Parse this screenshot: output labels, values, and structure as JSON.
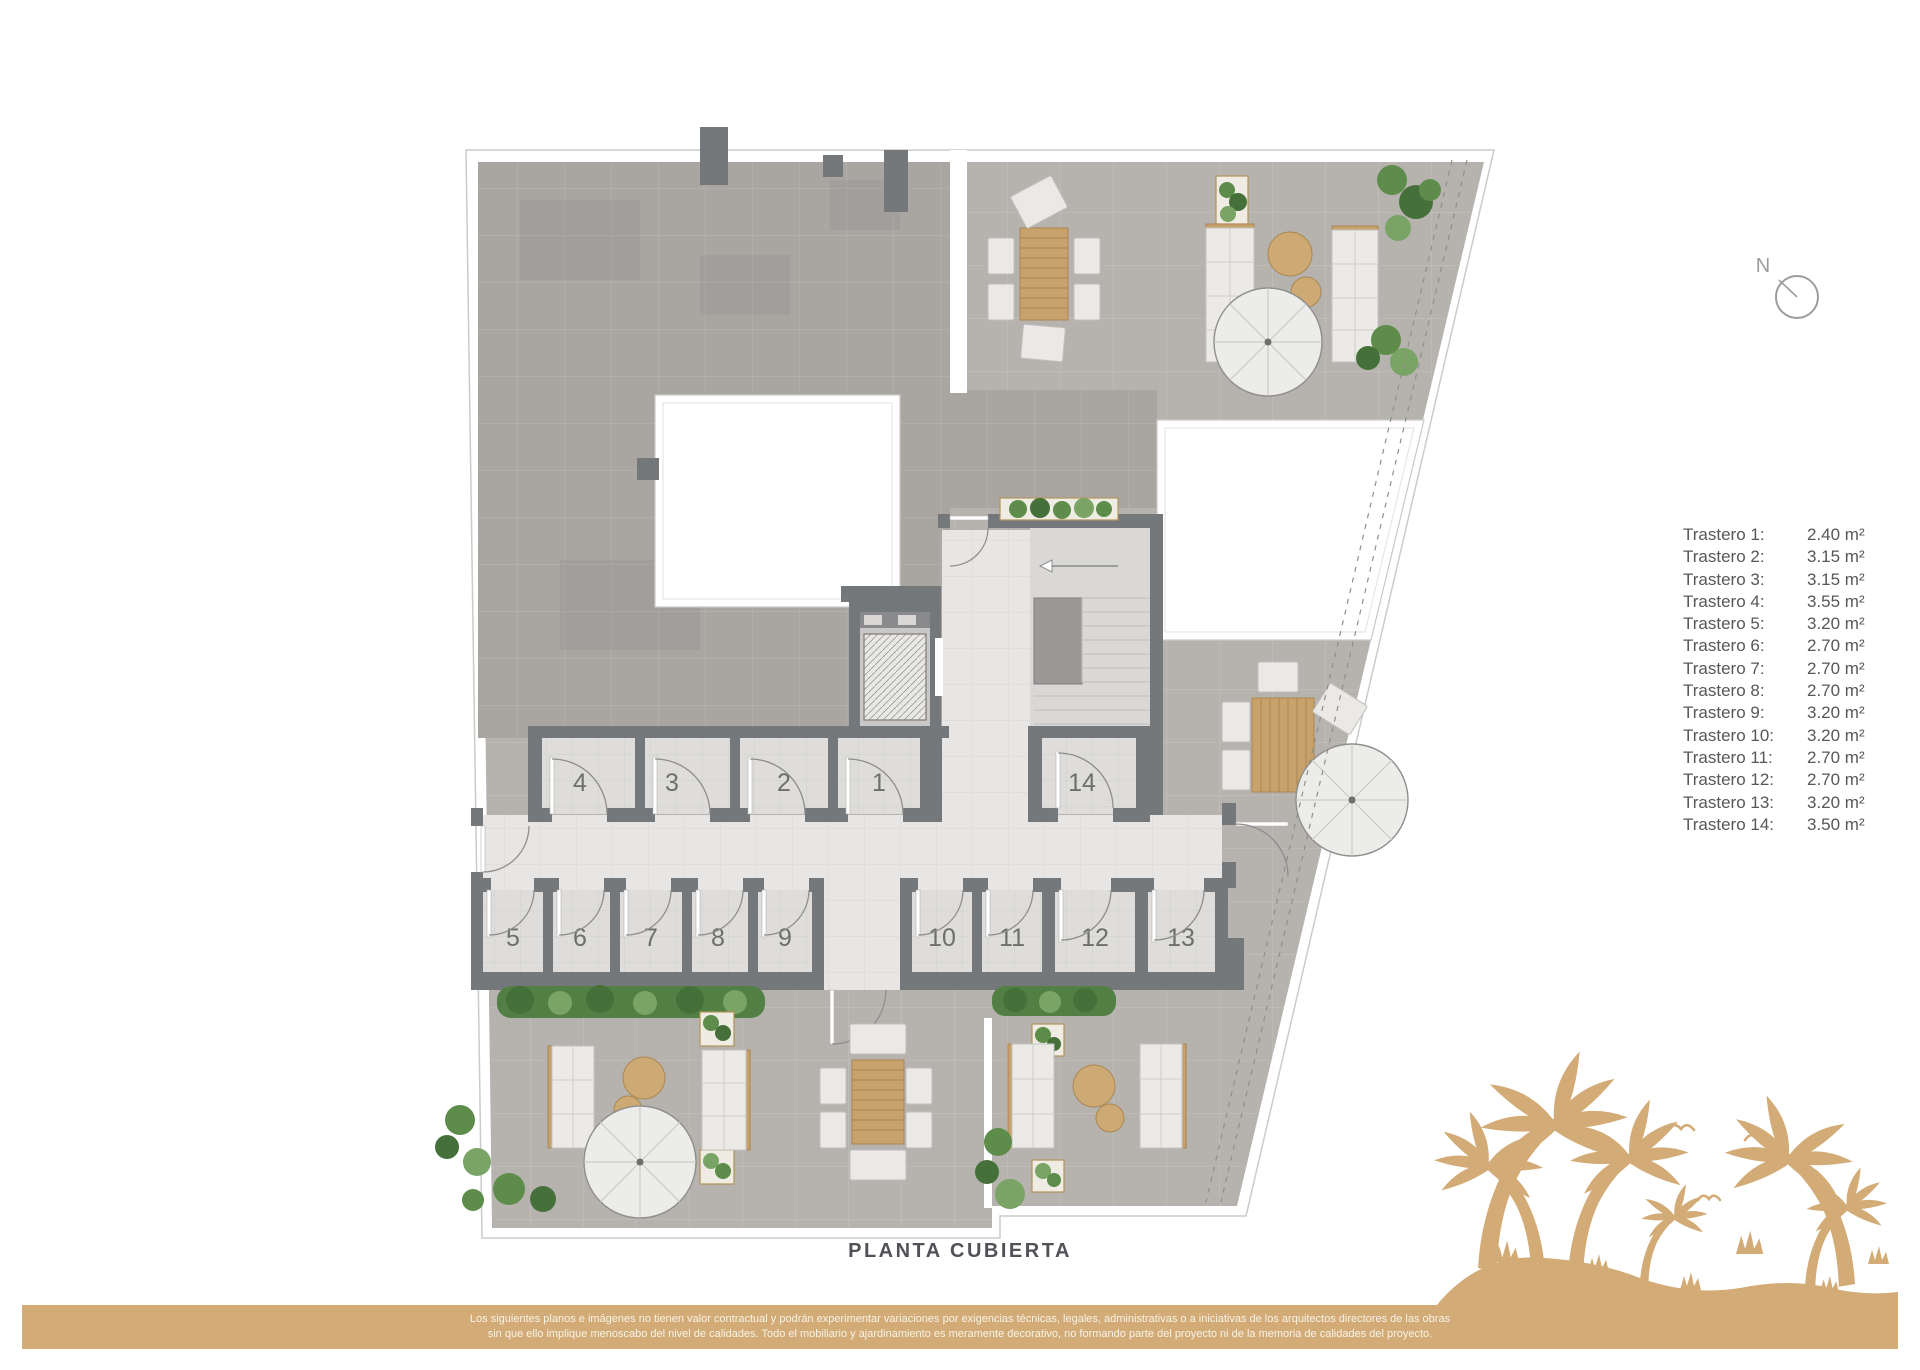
{
  "plan": {
    "title": "PLANTA CUBIERTA",
    "compass": {
      "label": "N"
    },
    "room_numbers": [
      "1",
      "2",
      "3",
      "4",
      "5",
      "6",
      "7",
      "8",
      "9",
      "10",
      "11",
      "12",
      "13",
      "14"
    ]
  },
  "legend": {
    "items": [
      {
        "label": "Trastero 1:",
        "value": "2.40 m²"
      },
      {
        "label": "Trastero 2:",
        "value": "3.15 m²"
      },
      {
        "label": "Trastero 3:",
        "value": "3.15 m²"
      },
      {
        "label": "Trastero 4:",
        "value": "3.55 m²"
      },
      {
        "label": "Trastero 5:",
        "value": "3.20 m²"
      },
      {
        "label": "Trastero 6:",
        "value": "2.70 m²"
      },
      {
        "label": "Trastero 7:",
        "value": "2.70 m²"
      },
      {
        "label": "Trastero 8:",
        "value": "2.70 m²"
      },
      {
        "label": "Trastero 9:",
        "value": "3.20 m²"
      },
      {
        "label": "Trastero 10:",
        "value": "3.20 m²"
      },
      {
        "label": "Trastero 11:",
        "value": "2.70 m²"
      },
      {
        "label": "Trastero 12:",
        "value": "2.70 m²"
      },
      {
        "label": "Trastero 13:",
        "value": "3.20 m²"
      },
      {
        "label": "Trastero 14:",
        "value": "3.50 m²"
      }
    ]
  },
  "footer": {
    "disclaimer_line1": "Los siguientes planos e imágenes no tienen valor contractual y podrán experimentar variaciones por exigencias técnicas, legales, administrativas o a iniciativas de los arquitectos directores de las obras",
    "disclaimer_line2": "sin que ello implique menoscabo del nivel de calidades. Todo el mobiliario y ajardinamiento es meramente decorativo, no formando parte del proyecto ni de la memoria de calidades del proyecto."
  },
  "colors": {
    "accent_tan": "#d2ab76",
    "wall_gray": "#75787b",
    "roof_tile": "#a9a6a2",
    "terrace_tile": "#b6b3af",
    "text_gray": "#56575a"
  }
}
